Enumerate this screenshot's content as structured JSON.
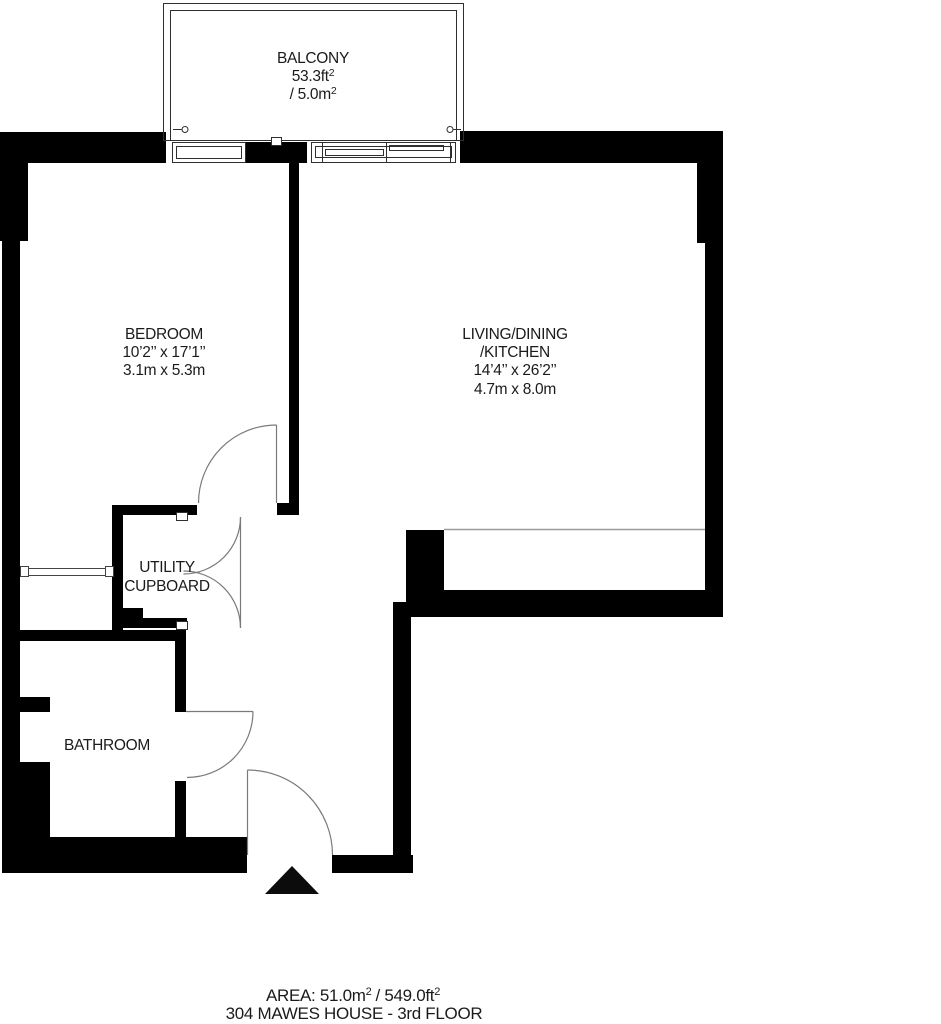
{
  "colors": {
    "wall": "#000000",
    "door_line": "#7a7a7a",
    "thin_line": "#2f2f2f",
    "text": "#1b1b1b",
    "background": "#ffffff"
  },
  "rooms": {
    "balcony": {
      "label": "BALCONY",
      "area_imperial": "53.3ft",
      "area_imperial_sup": "2",
      "area_metric": "/ 5.0m",
      "area_metric_sup": "2"
    },
    "bedroom": {
      "label": "BEDROOM",
      "dims_imperial": "10’2’’ x 17’1’’",
      "dims_metric": "3.1m x 5.3m"
    },
    "living": {
      "label_line1": "LIVING/DINING",
      "label_line2": "/KITCHEN",
      "dims_imperial": "14’4’’ x 26’2’’",
      "dims_metric": "4.7m x 8.0m"
    },
    "utility": {
      "label_line1": "UTILITY",
      "label_line2": "CUPBOARD"
    },
    "bathroom": {
      "label": "BATHROOM"
    }
  },
  "footer": {
    "area_prefix": "AREA: 51.0m",
    "area_sup1": "2",
    "area_mid": "/ 549.0ft",
    "area_sup2": "2",
    "address": "304 MAWES HOUSE - 3rd FLOOR"
  }
}
